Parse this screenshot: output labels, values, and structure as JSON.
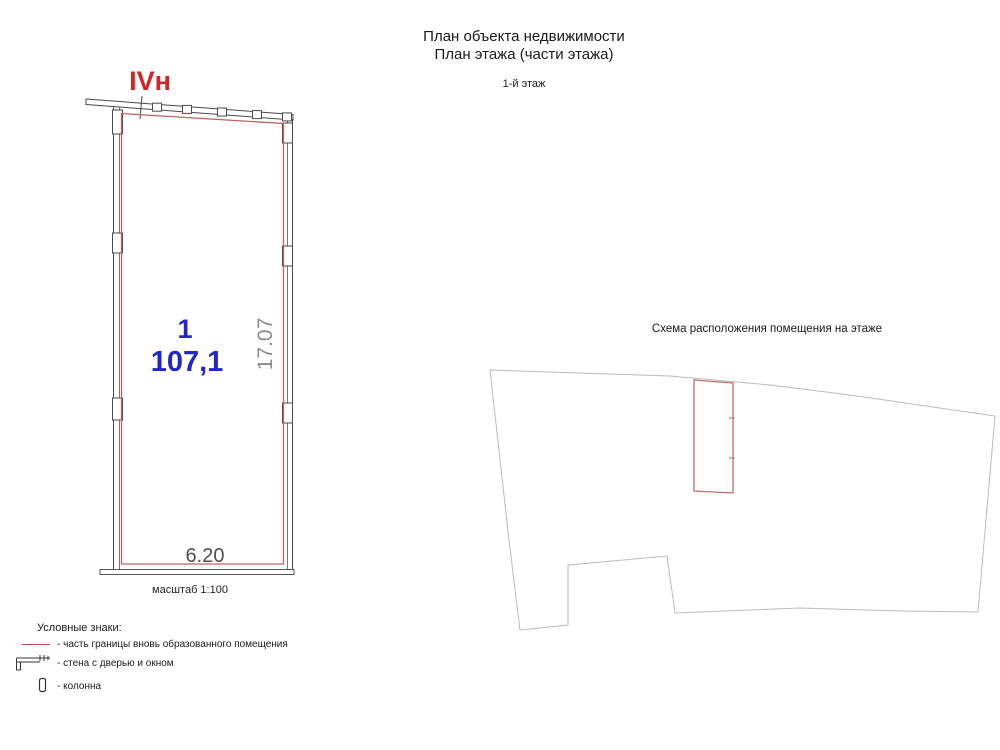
{
  "header": {
    "title_line1": "План объекта недвижимости",
    "title_line2": "План этажа (части этажа)",
    "floor_label": "1-й этаж"
  },
  "plan": {
    "premises_label": "IVн",
    "room_number": "1",
    "room_area": "107,1",
    "dim_vertical": "17.07",
    "dim_horizontal": "6.20",
    "scale_label": "масштаб 1:100"
  },
  "schema": {
    "title": "Схема расположения помещения на этаже"
  },
  "legend": {
    "heading": "Условные знаки:",
    "items": [
      {
        "icon": "red-boundary-line-icon",
        "label": "- часть границы вновь образованного помещения"
      },
      {
        "icon": "wall-with-door-window-icon",
        "label": "- стена с дверью и окном"
      },
      {
        "icon": "column-icon",
        "label": "- колонна"
      }
    ]
  },
  "colors": {
    "boundary_red": "#c06060",
    "schema_red": "#c76a6a",
    "label_red": "#d42424",
    "room_blue": "#2424cc",
    "wall_dark": "#4a4a4a",
    "schema_grey": "#bbbbbb",
    "dim_grey": "#8a8a8a",
    "dim_dark": "#4f4f4f"
  }
}
